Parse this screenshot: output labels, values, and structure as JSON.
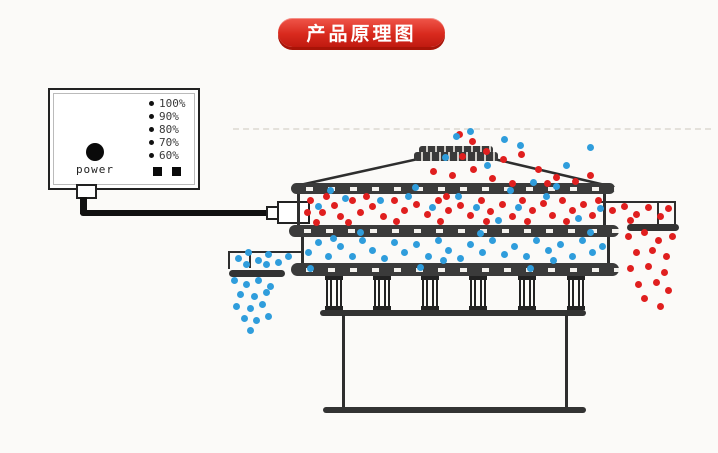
{
  "banner": {
    "title": "产品原理图"
  },
  "controller": {
    "power_label": "power",
    "levels": [
      "100%",
      "90%",
      "80%",
      "70%",
      "60%"
    ]
  },
  "colors": {
    "banner_red": "#d92a1e",
    "particle_red": "#e01f1f",
    "particle_blue": "#2f9ddc",
    "outline": "#2e2e2e"
  },
  "particles": {
    "red": [
      [
        459,
        134
      ],
      [
        472,
        141
      ],
      [
        486,
        151
      ],
      [
        462,
        156
      ],
      [
        503,
        159
      ],
      [
        521,
        154
      ],
      [
        538,
        169
      ],
      [
        556,
        177
      ],
      [
        575,
        181
      ],
      [
        473,
        169
      ],
      [
        452,
        175
      ],
      [
        433,
        171
      ],
      [
        492,
        178
      ],
      [
        512,
        183
      ],
      [
        590,
        175
      ],
      [
        547,
        183
      ],
      [
        310,
        200
      ],
      [
        322,
        212
      ],
      [
        316,
        222
      ],
      [
        334,
        205
      ],
      [
        340,
        216
      ],
      [
        352,
        200
      ],
      [
        360,
        212
      ],
      [
        348,
        222
      ],
      [
        372,
        206
      ],
      [
        383,
        216
      ],
      [
        394,
        200
      ],
      [
        404,
        210
      ],
      [
        396,
        221
      ],
      [
        416,
        204
      ],
      [
        427,
        214
      ],
      [
        438,
        200
      ],
      [
        448,
        210
      ],
      [
        440,
        221
      ],
      [
        460,
        205
      ],
      [
        470,
        215
      ],
      [
        481,
        200
      ],
      [
        490,
        211
      ],
      [
        502,
        204
      ],
      [
        512,
        216
      ],
      [
        522,
        200
      ],
      [
        532,
        210
      ],
      [
        543,
        203
      ],
      [
        552,
        215
      ],
      [
        562,
        200
      ],
      [
        572,
        210
      ],
      [
        583,
        204
      ],
      [
        592,
        215
      ],
      [
        598,
        200
      ],
      [
        326,
        196
      ],
      [
        366,
        196
      ],
      [
        446,
        196
      ],
      [
        486,
        221
      ],
      [
        566,
        221
      ],
      [
        527,
        221
      ],
      [
        307,
        212
      ],
      [
        612,
        210
      ],
      [
        624,
        206
      ],
      [
        636,
        214
      ],
      [
        648,
        207
      ],
      [
        660,
        216
      ],
      [
        668,
        208
      ],
      [
        630,
        220
      ],
      [
        628,
        236
      ],
      [
        644,
        232
      ],
      [
        658,
        240
      ],
      [
        672,
        236
      ],
      [
        636,
        252
      ],
      [
        652,
        250
      ],
      [
        666,
        256
      ],
      [
        630,
        268
      ],
      [
        648,
        266
      ],
      [
        664,
        272
      ],
      [
        638,
        284
      ],
      [
        656,
        282
      ],
      [
        668,
        290
      ],
      [
        644,
        298
      ],
      [
        660,
        306
      ]
    ],
    "blue": [
      [
        456,
        136
      ],
      [
        504,
        139
      ],
      [
        520,
        145
      ],
      [
        487,
        165
      ],
      [
        445,
        157
      ],
      [
        533,
        182
      ],
      [
        566,
        165
      ],
      [
        590,
        147
      ],
      [
        470,
        131
      ],
      [
        318,
        206
      ],
      [
        345,
        198
      ],
      [
        380,
        200
      ],
      [
        408,
        196
      ],
      [
        432,
        207
      ],
      [
        458,
        196
      ],
      [
        476,
        207
      ],
      [
        498,
        220
      ],
      [
        518,
        207
      ],
      [
        546,
        196
      ],
      [
        578,
        218
      ],
      [
        600,
        208
      ],
      [
        330,
        190
      ],
      [
        415,
        187
      ],
      [
        510,
        190
      ],
      [
        556,
        186
      ],
      [
        360,
        232
      ],
      [
        480,
        233
      ],
      [
        590,
        232
      ],
      [
        310,
        268
      ],
      [
        420,
        267
      ],
      [
        530,
        268
      ],
      [
        308,
        252
      ],
      [
        318,
        242
      ],
      [
        328,
        256
      ],
      [
        340,
        246
      ],
      [
        352,
        256
      ],
      [
        362,
        240
      ],
      [
        372,
        250
      ],
      [
        384,
        258
      ],
      [
        394,
        242
      ],
      [
        404,
        252
      ],
      [
        416,
        244
      ],
      [
        428,
        256
      ],
      [
        438,
        240
      ],
      [
        448,
        250
      ],
      [
        460,
        258
      ],
      [
        470,
        244
      ],
      [
        482,
        252
      ],
      [
        492,
        240
      ],
      [
        504,
        254
      ],
      [
        514,
        246
      ],
      [
        526,
        256
      ],
      [
        536,
        240
      ],
      [
        548,
        250
      ],
      [
        560,
        244
      ],
      [
        572,
        256
      ],
      [
        582,
        240
      ],
      [
        592,
        252
      ],
      [
        602,
        246
      ],
      [
        333,
        238
      ],
      [
        443,
        260
      ],
      [
        553,
        260
      ],
      [
        238,
        258
      ],
      [
        248,
        252
      ],
      [
        258,
        260
      ],
      [
        268,
        254
      ],
      [
        278,
        262
      ],
      [
        288,
        256
      ],
      [
        246,
        264
      ],
      [
        266,
        264
      ],
      [
        234,
        280
      ],
      [
        246,
        284
      ],
      [
        258,
        280
      ],
      [
        270,
        286
      ],
      [
        240,
        294
      ],
      [
        254,
        296
      ],
      [
        266,
        292
      ],
      [
        236,
        306
      ],
      [
        250,
        308
      ],
      [
        262,
        304
      ],
      [
        244,
        318
      ],
      [
        256,
        320
      ],
      [
        268,
        316
      ],
      [
        250,
        330
      ]
    ]
  }
}
